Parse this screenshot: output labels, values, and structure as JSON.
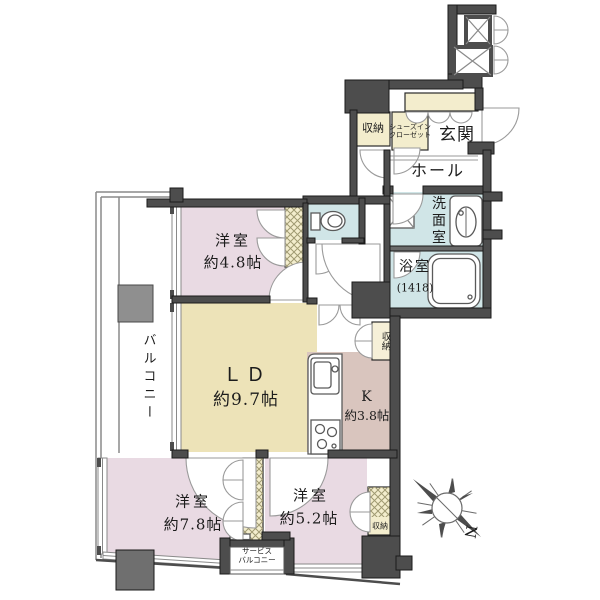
{
  "floorplan": {
    "title": "apartment-floor-plan",
    "rooms": {
      "genkan": {
        "label": "玄関"
      },
      "hall": {
        "label": "ホール"
      },
      "washroom": {
        "label": "洗面室"
      },
      "bathroom": {
        "label": "浴室",
        "size": "(1418)"
      },
      "entrance_storage": {
        "label": "収納"
      },
      "shoes_closet": {
        "line1": "シューズイン",
        "line2": "クローゼット"
      },
      "bedroom1": {
        "label": "洋室",
        "size": "約4.8帖"
      },
      "living_dining": {
        "label": "ＬＤ",
        "size": "約9.7帖"
      },
      "kitchen": {
        "label": "K",
        "size": "約3.8帖"
      },
      "ld_storage": {
        "label": "収納"
      },
      "bedroom2": {
        "label": "洋室",
        "size": "約7.8帖"
      },
      "bedroom3": {
        "label": "洋室",
        "size": "約5.2帖"
      },
      "bedroom3_storage": {
        "label": "収納"
      },
      "service_balcony": {
        "line1": "サービス",
        "line2": "バルコニー"
      },
      "balcony": {
        "label": "バルコニー"
      }
    },
    "compass": {
      "north_label": "N"
    },
    "colors": {
      "wall": "#4d4d4d",
      "bedroom_pink": "#e9dae3",
      "living_yellow": "#ede3b8",
      "kitchen_brown": "#d9c5be",
      "wet_area_blue": "#d0e5e7",
      "closet_yellow": "#f3edcd",
      "pillar_gray": "#8f8f8f"
    }
  }
}
